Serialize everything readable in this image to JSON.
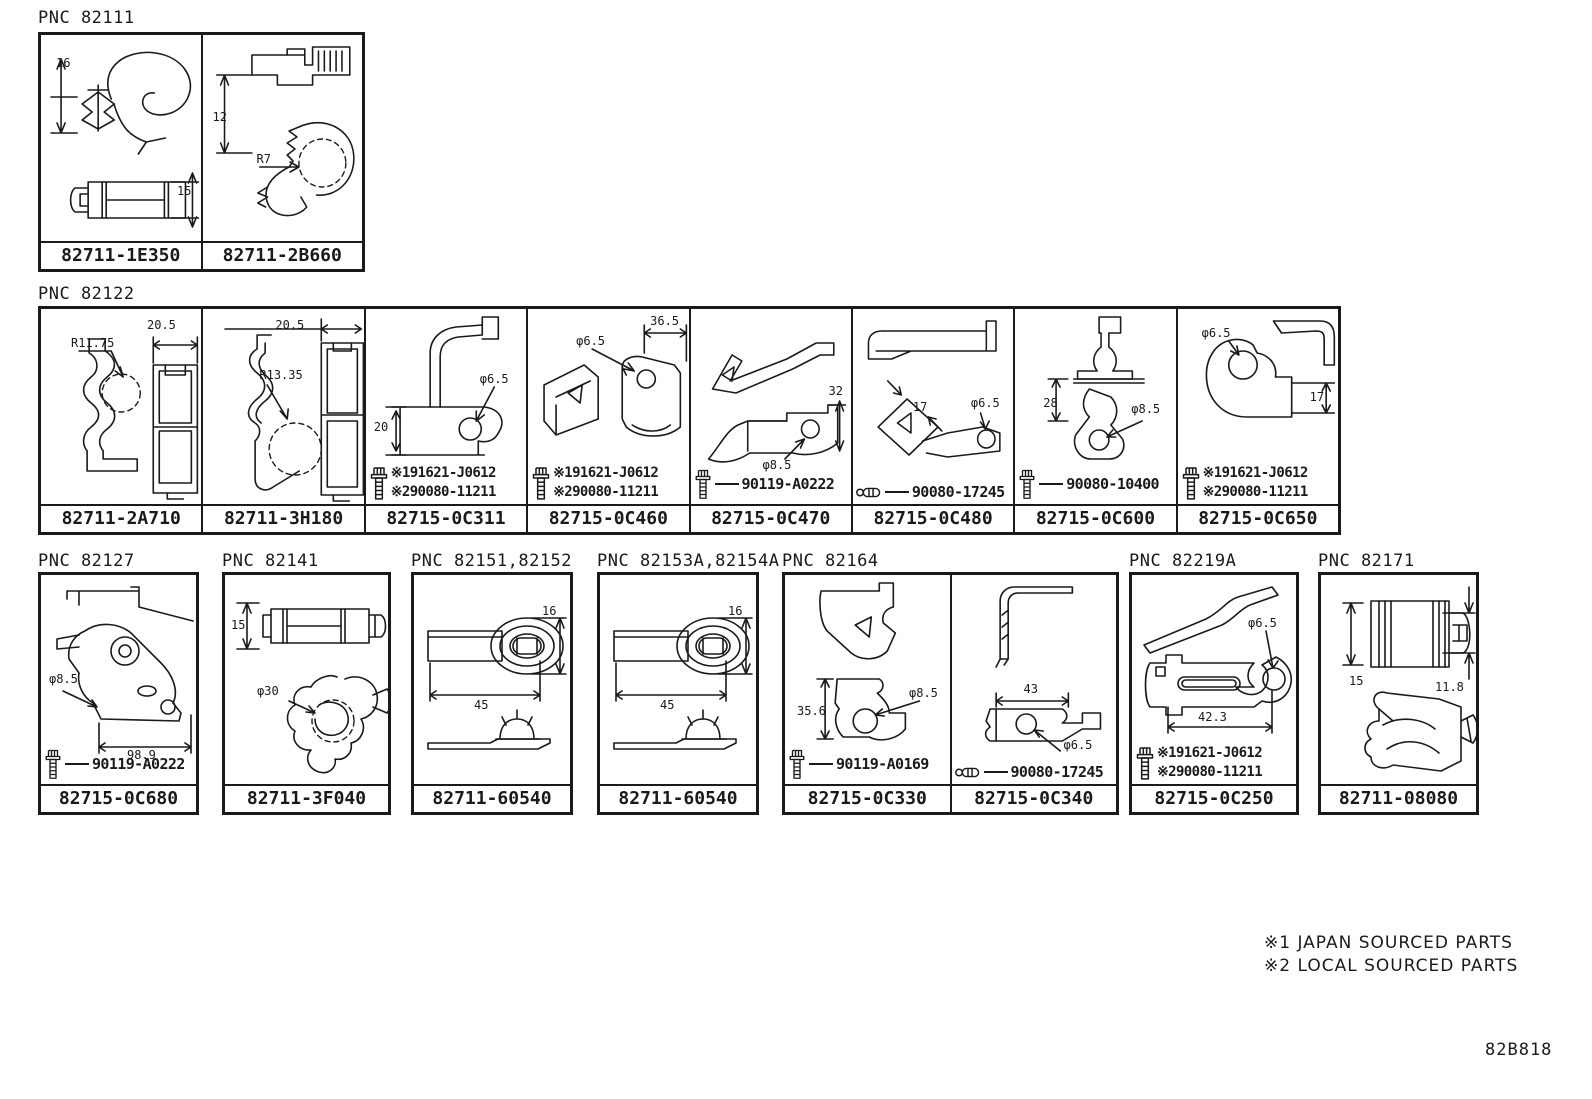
{
  "footer": {
    "notes": [
      "※1 JAPAN SOURCED PARTS",
      "※2 LOCAL SOURCED PARTS"
    ],
    "code": "82B818"
  },
  "groups": [
    {
      "pnc": "PNC 82111",
      "cells": [
        {
          "part_number": "82711-1E350",
          "dims": [
            "16",
            "15"
          ]
        },
        {
          "part_number": "82711-2B660",
          "dims": [
            "12",
            "R7"
          ]
        }
      ]
    },
    {
      "pnc": "PNC 82122",
      "cells": [
        {
          "part_number": "82711-2A710",
          "dims": [
            "R11.75",
            "20.5"
          ]
        },
        {
          "part_number": "82711-3H180",
          "dims": [
            "20.5",
            "R13.35"
          ]
        },
        {
          "part_number": "82715-0C311",
          "dims": [
            "φ6.5",
            "20"
          ],
          "fastener": {
            "icon": "bolt",
            "lines": [
              "※191621-J0612",
              "※290080-11211"
            ]
          }
        },
        {
          "part_number": "82715-0C460",
          "dims": [
            "φ6.5",
            "36.5"
          ],
          "fastener": {
            "icon": "bolt",
            "lines": [
              "※191621-J0612",
              "※290080-11211"
            ]
          }
        },
        {
          "part_number": "82715-0C470",
          "dims": [
            "32",
            "φ8.5"
          ],
          "fastener": {
            "icon": "bolt",
            "lines": [
              "90119-A0222"
            ]
          }
        },
        {
          "part_number": "82715-0C480",
          "dims": [
            "17",
            "φ6.5"
          ],
          "fastener": {
            "icon": "pin",
            "lines": [
              "90080-17245"
            ]
          }
        },
        {
          "part_number": "82715-0C600",
          "dims": [
            "28",
            "φ8.5"
          ],
          "fastener": {
            "icon": "bolt",
            "lines": [
              "90080-10400"
            ]
          }
        },
        {
          "part_number": "82715-0C650",
          "dims": [
            "φ6.5",
            "17"
          ],
          "fastener": {
            "icon": "bolt",
            "lines": [
              "※191621-J0612",
              "※290080-11211"
            ]
          }
        }
      ]
    },
    {
      "pnc": "PNC 82127",
      "cells": [
        {
          "part_number": "82715-0C680",
          "dims": [
            "φ8.5",
            "98.9"
          ],
          "fastener": {
            "icon": "bolt",
            "lines": [
              "90119-A0222"
            ]
          }
        }
      ]
    },
    {
      "pnc": "PNC 82141",
      "cells": [
        {
          "part_number": "82711-3F040",
          "dims": [
            "15",
            "φ30"
          ]
        }
      ]
    },
    {
      "pnc": "PNC 82151,82152",
      "cells": [
        {
          "part_number": "82711-60540",
          "dims": [
            "16",
            "45"
          ]
        }
      ]
    },
    {
      "pnc": "PNC 82153A,82154A",
      "cells": [
        {
          "part_number": "82711-60540",
          "dims": [
            "16",
            "45"
          ]
        }
      ]
    },
    {
      "pnc": "PNC 82164",
      "cells": [
        {
          "part_number": "82715-0C330",
          "dims": [
            "35.6",
            "φ8.5"
          ],
          "fastener": {
            "icon": "bolt",
            "lines": [
              "90119-A0169"
            ]
          }
        },
        {
          "part_number": "82715-0C340",
          "dims": [
            "43",
            "φ6.5"
          ],
          "fastener": {
            "icon": "pin",
            "lines": [
              "90080-17245"
            ]
          }
        }
      ]
    },
    {
      "pnc": "PNC 82219A",
      "cells": [
        {
          "part_number": "82715-0C250",
          "dims": [
            "φ6.5",
            "42.3"
          ],
          "fastener": {
            "icon": "bolt",
            "lines": [
              "※191621-J0612",
              "※290080-11211"
            ]
          }
        }
      ]
    },
    {
      "pnc": "PNC 82171",
      "cells": [
        {
          "part_number": "82711-08080",
          "dims": [
            "15",
            "11.8"
          ]
        }
      ]
    }
  ]
}
